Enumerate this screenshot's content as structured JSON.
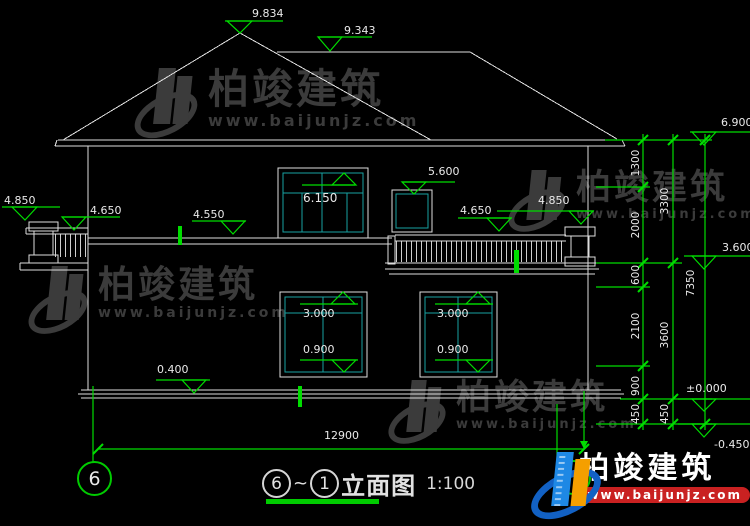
{
  "watermark": {
    "brand": "柏竣建筑",
    "url": "www.baijunjz.com"
  },
  "brand_logo": {
    "brand": "柏竣建筑",
    "url": "www.baijunjz.com"
  },
  "title_block": {
    "bubble_left": "6",
    "tilde": "~",
    "bubble_right": "1",
    "name": "立面图",
    "scale": "1:100"
  },
  "axis_bubbles": {
    "left": "6"
  },
  "elevations": {
    "roof_peak": "9.834",
    "roof_ridge": "9.343",
    "eave": "6.900",
    "level_3600": "3.600",
    "ground": "±0.000",
    "below_ground": "-0.450",
    "parapet_left": "4.850",
    "belt_left": "4.650",
    "belt_mid": "4.550",
    "window2f_top": "6.150",
    "window2f_small_top": "5.600",
    "belt_right": "4.650",
    "parapet_right": "4.850",
    "plinth": "0.400",
    "window_top": "3.000",
    "window_sill": "0.900"
  },
  "dimensions": {
    "total_width": "12900",
    "right_chain_inner": [
      "1300",
      "2000",
      "600",
      "2100",
      "900",
      "450"
    ],
    "right_chain_middle": [
      "3300",
      "3600",
      "450"
    ],
    "right_chain_outer": [
      "7350"
    ]
  }
}
